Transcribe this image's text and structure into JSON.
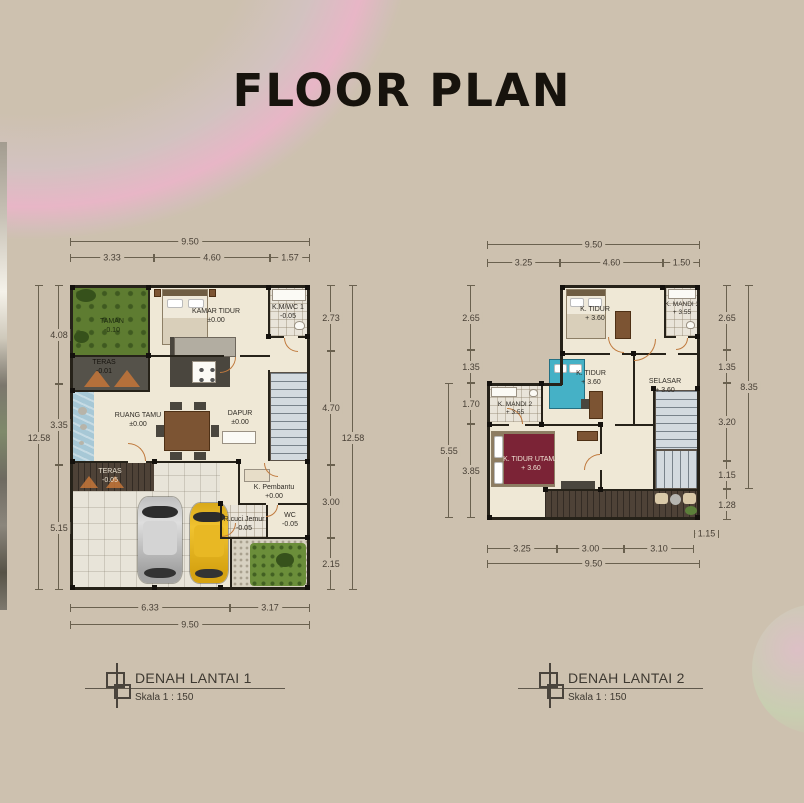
{
  "title": "FLOOR PLAN",
  "colors": {
    "background": "#cdc1af",
    "walls": "#262219",
    "title": "#17130d",
    "doors": "#c07a3e",
    "garden_green": "#5e7c31",
    "pond_blue": "#a7c8d6",
    "deck_brown": "#4e4237",
    "master_bed": "#7b2336",
    "bed_blue": "#45b1c6",
    "car_yellow": "#e5b61f",
    "car_silver": "#c9c9c9",
    "dimension_text": "#473f35"
  },
  "plan1": {
    "caption": "DENAH LANTAI 1",
    "scale": "Skala 1 : 150",
    "rooms": {
      "taman": {
        "label": "TAMAN",
        "level": "-0.10"
      },
      "teras_atas": {
        "label": "TERAS",
        "level": "-0.01"
      },
      "kamar_tidur": {
        "label": "KAMAR TIDUR",
        "level": "±0.00"
      },
      "kmwc1": {
        "label": "K.M/WC 1",
        "level": "-0.05"
      },
      "ruang_tamu": {
        "label": "RUANG TAMU",
        "level": "±0.00"
      },
      "dapur": {
        "label": "DAPUR",
        "level": "±0.00"
      },
      "k_pembantu": {
        "label": "K. Pembantu",
        "level": "+0.00"
      },
      "wc": {
        "label": "WC",
        "level": "-0.05"
      },
      "r_cuci": {
        "label": "R.cuci Jemur",
        "level": "-0.05"
      },
      "teras_bawah": {
        "label": "TERAS",
        "level": "-0.05"
      },
      "carport": {
        "label": "CARPORT"
      }
    },
    "dims": {
      "top_total": "9.50",
      "top": [
        "3.33",
        "4.60",
        "1.57"
      ],
      "left_total": "12.58",
      "left": [
        "4.08",
        "3.35",
        "5.15"
      ],
      "right_total": "12.58",
      "right": [
        "2.73",
        "4.70",
        "3.00",
        "2.15"
      ],
      "bottom": [
        "6.33",
        "3.17"
      ],
      "bottom_total": "9.50"
    }
  },
  "plan2": {
    "caption": "DENAH LANTAI 2",
    "scale": "Skala 1 : 150",
    "rooms": {
      "k_tidur_atas": {
        "label": "K. TIDUR",
        "level": "+ 3.60"
      },
      "k_mandi3": {
        "label": "K. MANDI 3",
        "level": "+ 3.55"
      },
      "k_tidur_tengah": {
        "label": "K. TIDUR",
        "level": "+ 3.60"
      },
      "selasar": {
        "label": "SELASAR",
        "level": "+ 3.60"
      },
      "k_mandi2": {
        "label": "K. MANDI 2",
        "level": "+ 3.55"
      },
      "k_tidur_utama": {
        "label": "K. TIDUR UTAMA",
        "level": "+ 3.60"
      }
    },
    "dims": {
      "top_total": "9.50",
      "top": [
        "3.25",
        "4.60",
        "1.50"
      ],
      "left_upper": [
        "2.65",
        "1.35"
      ],
      "left_lower_total": "5.55",
      "left_lower": [
        "1.70",
        "3.85"
      ],
      "right_total": "8.35",
      "right": [
        "2.65",
        "1.35",
        "3.20",
        "1.15"
      ],
      "right_below": "1.28",
      "bottom": [
        "3.25",
        "3.00",
        "3.10",
        "1.15"
      ],
      "bottom_total": "9.50"
    }
  }
}
